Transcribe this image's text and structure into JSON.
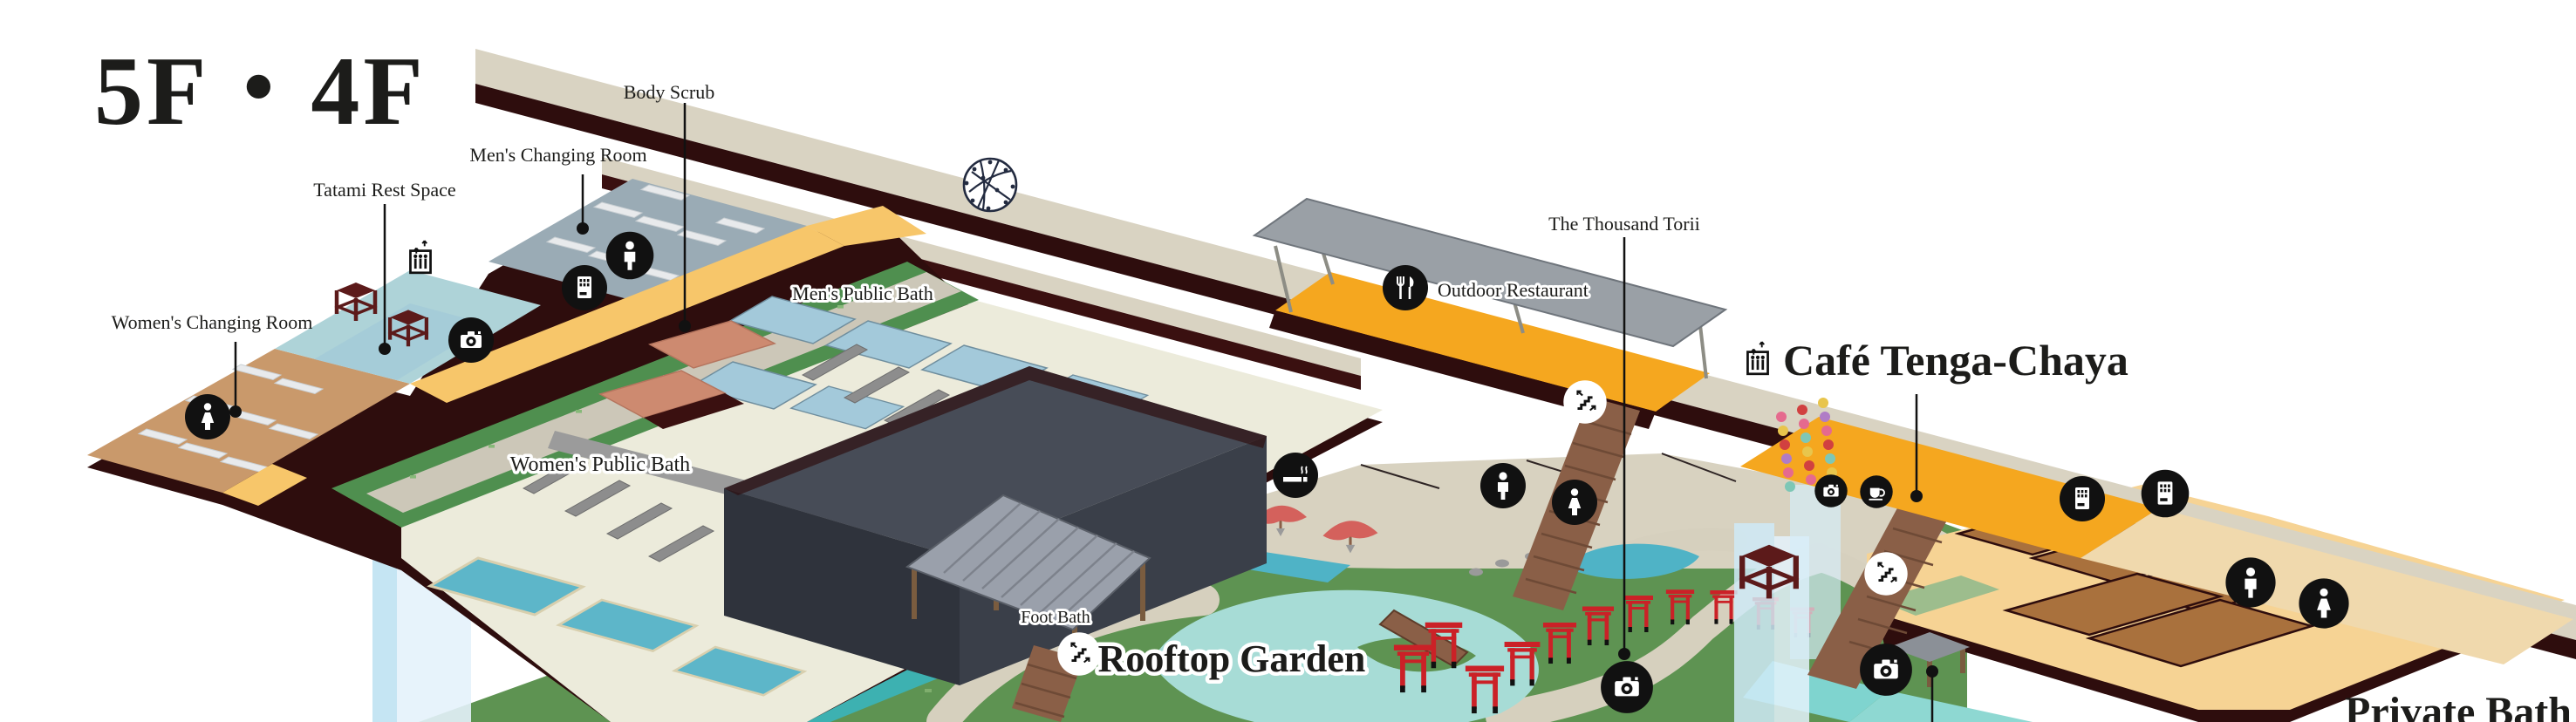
{
  "title": "5F・4F",
  "floors": {
    "f5": {
      "name": "5F",
      "areas": {
        "womens_changing_room": "Women's Changing Room",
        "tatami_rest_space": "Tatami Rest Space",
        "mens_changing_room": "Men's Changing Room",
        "body_scrub": "Body Scrub",
        "mens_public_bath": "Men's Public Bath",
        "womens_public_bath": "Women's Public Bath",
        "outdoor_restaurant": "Outdoor Restaurant",
        "cafe": "Café Tenga-Chaya"
      }
    },
    "f4": {
      "name": "4F",
      "areas": {
        "rooftop_garden": "Rooftop Garden",
        "foot_bath": "Foot Bath",
        "thousand_torii": "The Thousand Torii",
        "private_bath": "Private Bath"
      }
    }
  },
  "icons": {
    "legend": [
      {
        "name": "camera-icon",
        "meaning": "photo spot"
      },
      {
        "name": "stairs-icon",
        "meaning": "stairs between 5F and 4F"
      },
      {
        "name": "elevator-icon",
        "meaning": "elevator"
      },
      {
        "name": "vending-machine-icon",
        "meaning": "vending machine"
      },
      {
        "name": "mens-room-icon",
        "meaning": "men"
      },
      {
        "name": "womens-room-icon",
        "meaning": "women"
      },
      {
        "name": "smoking-icon",
        "meaning": "smoking area"
      },
      {
        "name": "restaurant-icon",
        "meaning": "restaurant"
      },
      {
        "name": "coffee-icon",
        "meaning": "café"
      },
      {
        "name": "lattice-sphere-icon",
        "meaning": "decorative emblem"
      }
    ]
  },
  "colors": {
    "background": "#ffffff",
    "floor_cream": "#edecdc",
    "floor_edge_maroon": "#2e0d0d",
    "walkway_beige": "#d9d3c2",
    "walkway_orange": "#f5a71f",
    "accent_yellow": "#f7c66a",
    "garden_green": "#5e9352",
    "strip_green": "#4f8f4f",
    "pool_blue": "#a3c9da",
    "pond_teal": "#a7dcd6",
    "stream_teal": "#3db1b1",
    "mens_changing_gray": "#9aabb5",
    "womens_changing_tan": "#c9996b",
    "tatami_teal": "#aed3d8",
    "body_scrub_salmon": "#cd8a70",
    "building_slate": "#474c57",
    "stairs_brown": "#8a5f47",
    "torii_red": "#cb2127",
    "furniture_maroon": "#5c1a1a",
    "private_bath_tan": "#f6d394",
    "private_room_brown": "#a9713d",
    "elevator_shaft_blue": "#cfeaf7",
    "icon_black": "#111111"
  }
}
